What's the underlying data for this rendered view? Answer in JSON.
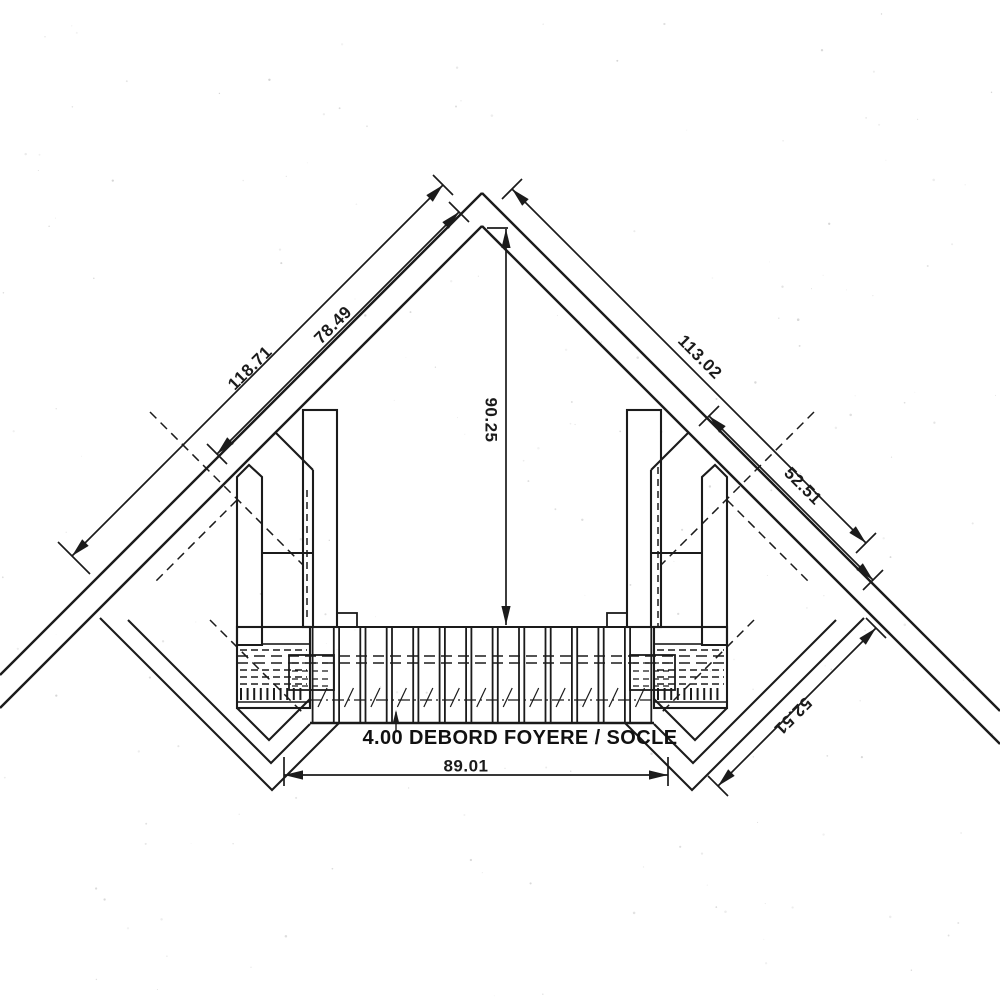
{
  "drawing": {
    "annotation": "4.00 DEBORD FOYERE / SOCLE",
    "dimensions": {
      "left_wall_outer": "118.71",
      "left_wall_inner": "78.49",
      "right_wall_outer": "113.02",
      "right_wall_upper": "52.51",
      "corner_to_hearth_front": "90.25",
      "hearth_front_width": "89.01",
      "hearth_side": "52.51"
    },
    "colors": {
      "ink": "#1b1b1b",
      "paper": "#ffffff"
    }
  }
}
